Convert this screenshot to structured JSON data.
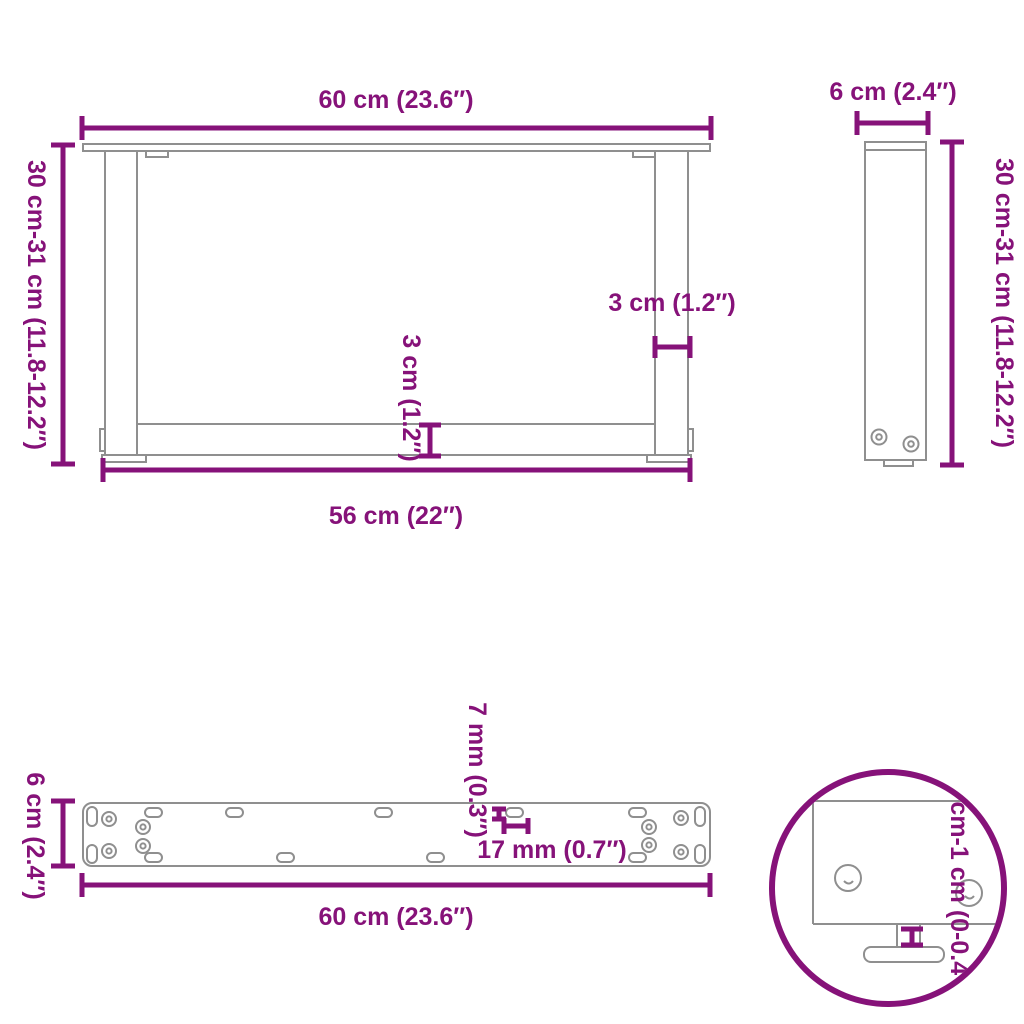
{
  "diagram": {
    "type": "technical-dimension-drawing",
    "subject": "U-shaped coffee table legs",
    "colors": {
      "dimension": "#861279",
      "drawing_lines": "#8f8f8f",
      "background": "#ffffff"
    },
    "views": {
      "front": {
        "label": "front-view-u-shaped-leg-frame",
        "dim_top_width": "60 cm (23.6″)",
        "dim_left_height": "30 cm-31 cm (11.8-12.2″)",
        "dim_leg_thickness": "3 cm (1.2″)",
        "dim_crossbar_thickness": "3 cm (1.2″)",
        "dim_bottom_width": "56 cm (22″)"
      },
      "side": {
        "label": "side-view-single-leg",
        "dim_top_depth": "6 cm (2.4″)",
        "dim_right_height": "30 cm-31 cm (11.8-12.2″)"
      },
      "plate": {
        "label": "top-view-mounting-plate",
        "dim_left_depth": "6 cm (2.4″)",
        "dim_bottom_width": "60 cm (23.6″)",
        "dim_slot_width": "7 mm (0.3″)",
        "dim_slot_length": "17 mm (0.7″)"
      },
      "detail": {
        "label": "detail-adjustable-foot",
        "dim_foot_adjustment": "0 cm-1 cm (0-0.4″)"
      }
    }
  }
}
